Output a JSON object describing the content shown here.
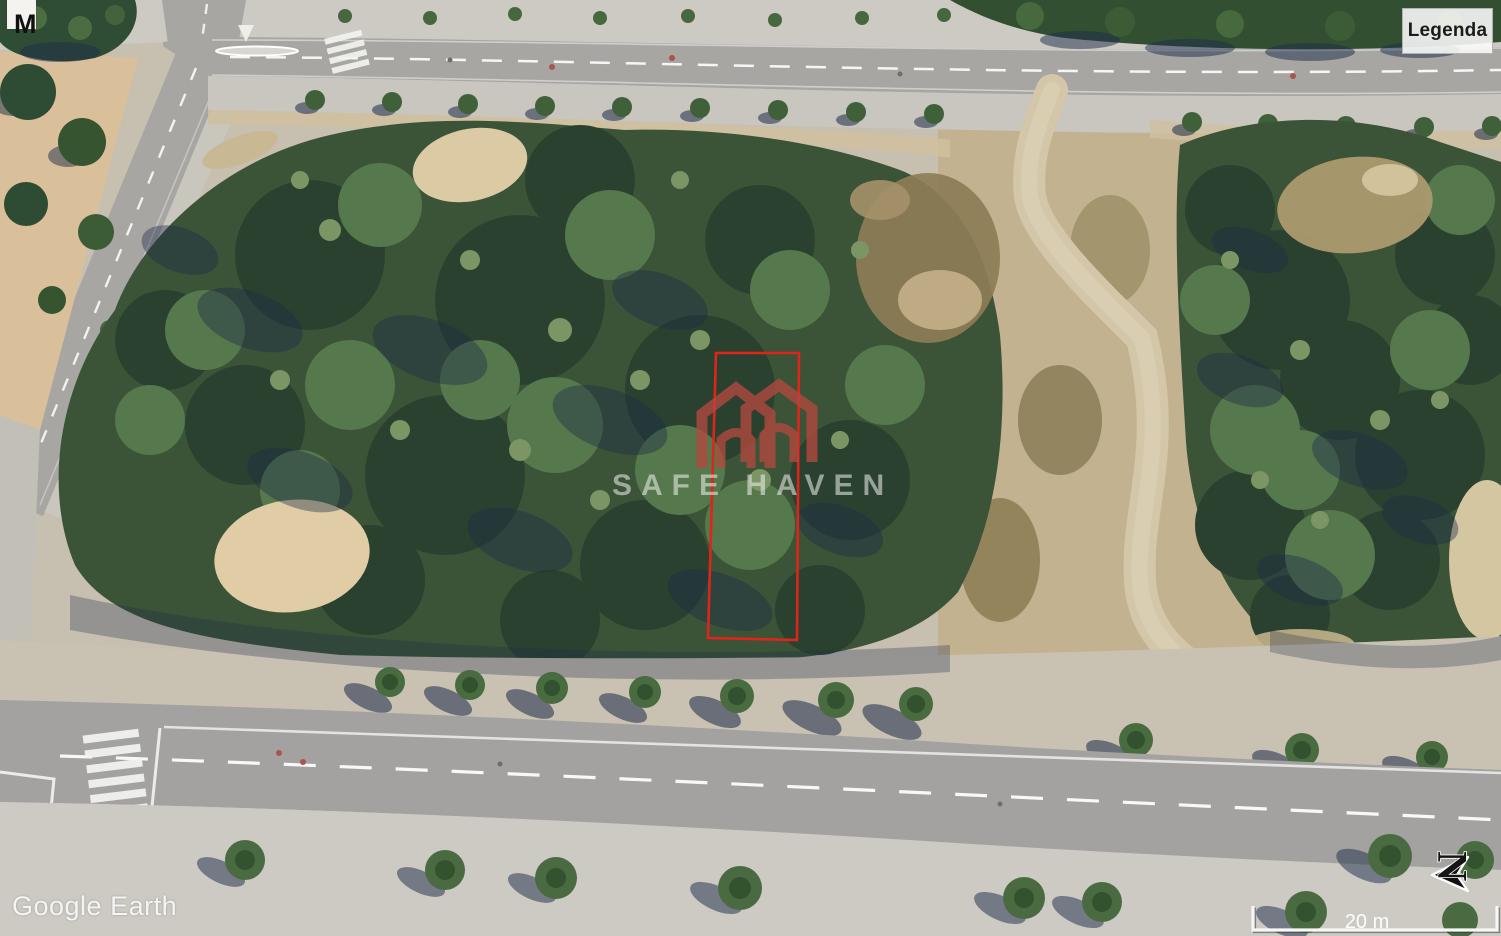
{
  "map": {
    "provider_watermark": "Google Earth",
    "scale_bar_label": "20 m",
    "compass_label": "N",
    "placemark_label": "M"
  },
  "legend": {
    "button_label": "Legenda"
  },
  "brand_overlay": {
    "name": "SAFE HAVEN",
    "logo_color": "#b2493e",
    "text_color": "#f0f3f0"
  },
  "plot_overlay": {
    "boundary_color": "#e0241a"
  },
  "colors": {
    "vegetation_dark": "#2a4130",
    "vegetation_mid": "#3b5337",
    "vegetation_light": "#55784c",
    "sand": "#d2c2a0",
    "road_asphalt": "#a7a6a3",
    "sidewalk": "#c9c6bf",
    "tree_shadow_navy": "#1d2b4a"
  }
}
